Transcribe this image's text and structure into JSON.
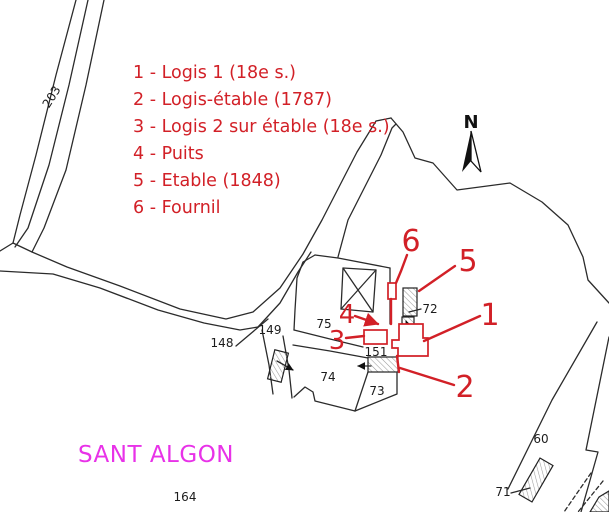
{
  "title": "Site plan",
  "place": {
    "name": "SANT ALGON"
  },
  "north": {
    "label": "N"
  },
  "legend": {
    "items": [
      "1 - Logis 1 (18e s.)",
      "2 - Logis-étable (1787)",
      "3 - Logis 2 sur étable (18e s.)",
      "4 - Puits",
      "5 - Etable (1848)",
      "6 - Fournil"
    ]
  },
  "callouts": {
    "c1": "1",
    "c2": "2",
    "c3": "3",
    "c4": "4",
    "c5": "5",
    "c6": "6"
  },
  "parcels": {
    "p203": "203",
    "p148": "148",
    "p149": "149",
    "p75": "75",
    "p151": "151",
    "p74": "74",
    "p73": "73",
    "p72": "72",
    "p60": "60",
    "p71": "71",
    "p164": "164"
  },
  "colors": {
    "legend_red": "#d22027",
    "place_magenta": "#e832e8",
    "line_black": "#2b2b2b"
  }
}
